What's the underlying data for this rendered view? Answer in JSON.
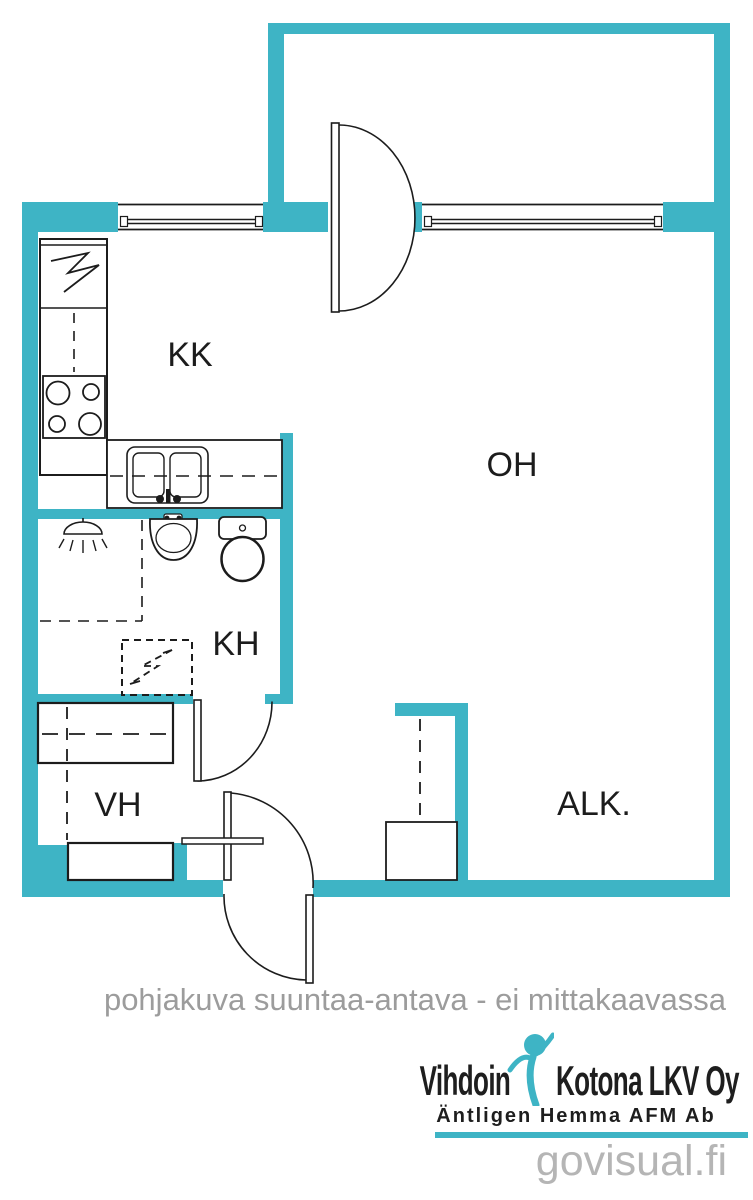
{
  "plan": {
    "labels": {
      "kk": "KK",
      "oh": "OH",
      "kh": "KH",
      "vh": "VH",
      "alk": "ALK."
    },
    "disclaimer": "pohjakuva suuntaa-antava - ei mittakaavassa"
  },
  "branding": {
    "name_left": "Vihdoin",
    "name_right": "Kotona LKV Oy",
    "tagline": "Äntligen Hemma AFM Ab",
    "watermark": "govisual.fi"
  },
  "colors": {
    "wall": "#3EB4C5",
    "line": "#1C1C1C",
    "disclaimer_text": "#9C9C9C",
    "watermark_text": "#B5B5B5",
    "logo_text": "#1E1E1E"
  },
  "icons": {
    "electrical_panel": "lightning-bolt-in-box",
    "stove": "four-burner-stove",
    "kitchen_sink": "double-basin-sink",
    "shower": "shower-head-spray",
    "washbasin": "oval-washbasin",
    "toilet": "toilet-with-cistern",
    "washing_machine": "dashed-appliance-reservation",
    "wardrobe": "wardrobe-cabinet",
    "logo_figure": "person-arms-raised"
  }
}
